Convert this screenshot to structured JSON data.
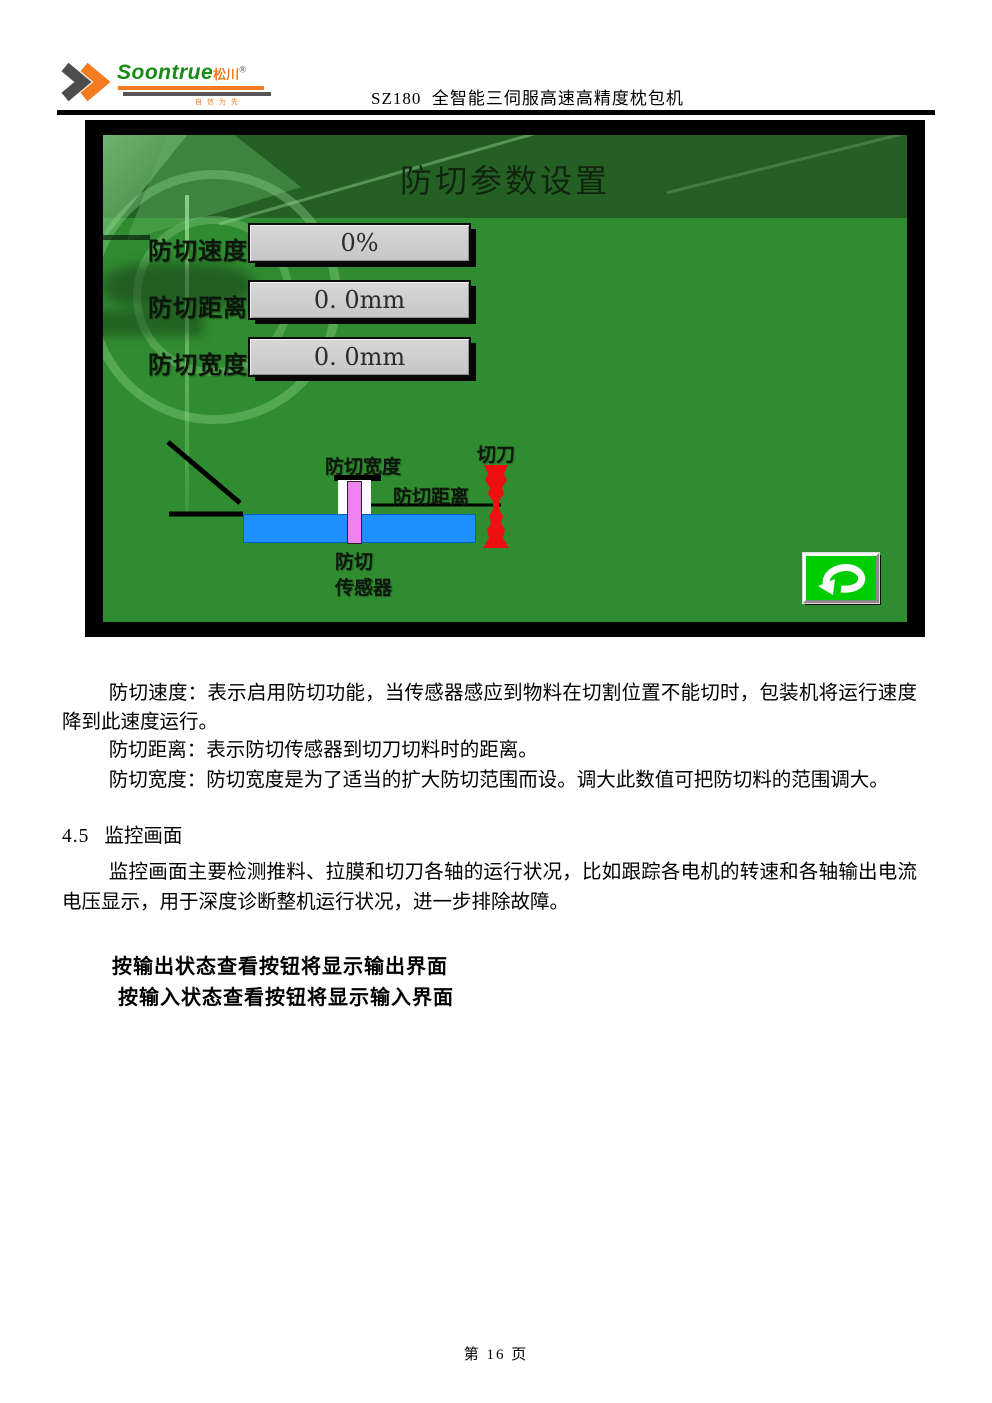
{
  "colors": {
    "hmi-green": "#308c30",
    "hmi-band": "#245f24",
    "field-gray": "#c6c6c6",
    "belt-blue": "#1e90ff",
    "sensor-pink": "#ee82ee",
    "cutter-red": "#ee1010",
    "button-green": "#00cd00",
    "brand-green": "#168a16",
    "brand-orange": "#f47b20"
  },
  "header": {
    "brand": "Soontrue",
    "brand_cn": "松川",
    "reg_mark": "®",
    "slogan": "自信为先",
    "doc_title": "SZ180  全智能三伺服高速高精度枕包机"
  },
  "hmi": {
    "title": "防切参数设置",
    "fields": [
      {
        "label": "防切速度",
        "value": "0%"
      },
      {
        "label": "防切距离",
        "value": "0. 0mm"
      },
      {
        "label": "防切宽度",
        "value": "0. 0mm"
      }
    ],
    "diagram": {
      "width_label": "防切宽度",
      "distance_label": "防切距离",
      "cutter_label": "切刀",
      "sensor_label_1": "防切",
      "sensor_label_2": "传感器"
    }
  },
  "content": {
    "para_speed": "防切速度：表示启用防切功能，当传感器感应到物料在切割位置不能切时，包装机将运行速度降到此速度运行。",
    "para_distance": "防切距离：表示防切传感器到切刀切料时的距离。",
    "para_width": "防切宽度：防切宽度是为了适当的扩大防切范围而设。调大此数值可把防切料的范围调大。",
    "section_number": "4.5",
    "section_title": "监控画面",
    "para_monitor": "监控画面主要检测推料、拉膜和切刀各轴的运行状况，比如跟踪各电机的转速和各轴输出电流电压显示，用于深度诊断整机运行状况，进一步排除故障。",
    "bold_line_output": "按输出状态查看按钮将显示输出界面",
    "bold_line_input": "按输入状态查看按钮将显示输入界面"
  },
  "footer": {
    "page_label": "第 16 页"
  }
}
